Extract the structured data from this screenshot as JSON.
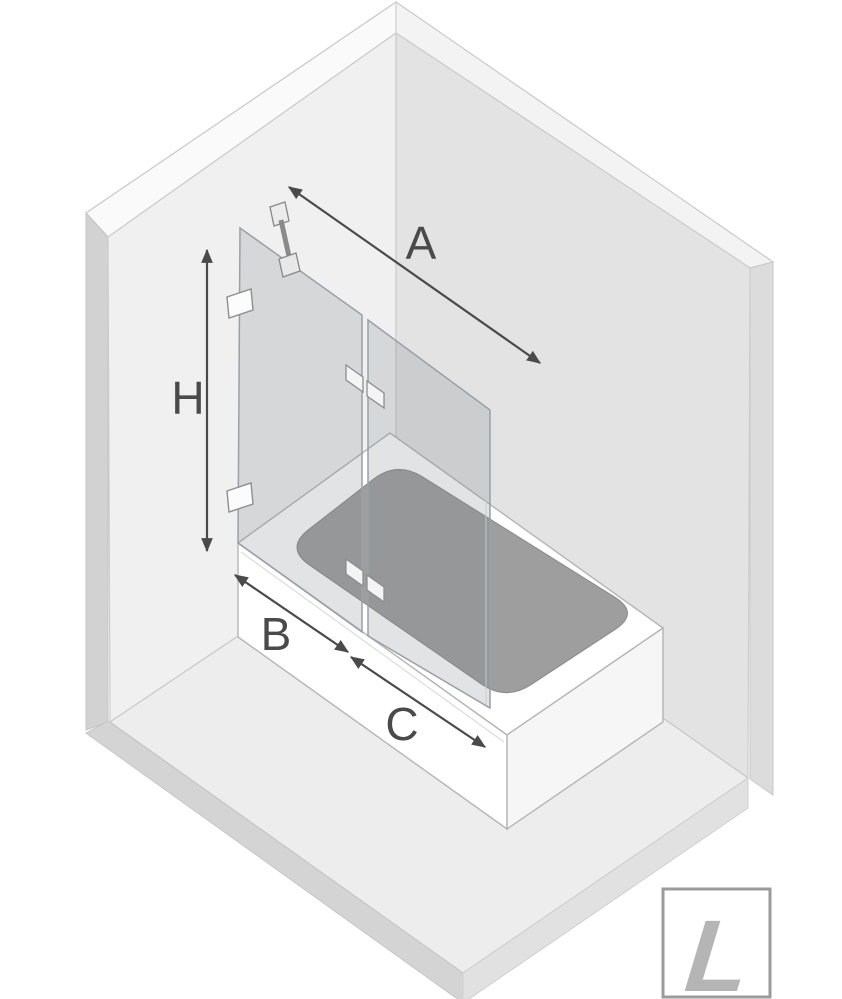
{
  "diagram": {
    "dimension_labels": {
      "a": "A",
      "h": "H",
      "b": "B",
      "c": "C"
    },
    "logo": {
      "letter": "L"
    },
    "colors": {
      "wall_left": "#f0f0f0",
      "wall_right": "#e3e3e3",
      "floor": "#ededed",
      "tub_white": "#ffffff",
      "basin_gray": "#9e9e9e",
      "glass_tint": "rgba(120,128,136,0.22)",
      "glass_edge": "#9aa0a6",
      "dimension_color": "#4a4a4a",
      "logo_gray": "#b5b5b5",
      "logo_border": "#9b9b9b"
    }
  }
}
